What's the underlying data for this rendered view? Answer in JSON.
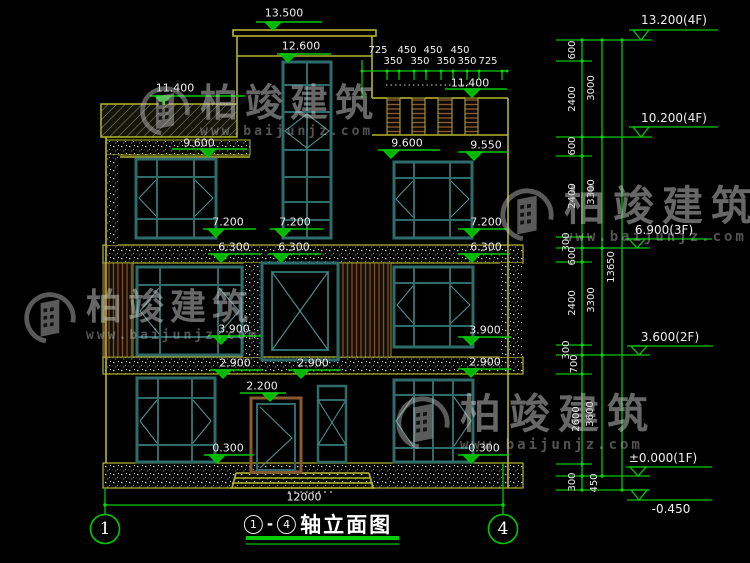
{
  "drawing": {
    "title": {
      "from": "1",
      "dash": "-",
      "to": "4",
      "name": "轴立面图"
    },
    "axes": {
      "a1": "1",
      "a4": "4"
    },
    "elev": {
      "v13500": "13.500",
      "v12600": "12.600",
      "v11400": "11.400",
      "v9600": "9.600",
      "v9550": "9.550",
      "v7200": "7.200",
      "v6300": "6.300",
      "v3900": "3.900",
      "v2900": "2.900",
      "v2200": "2.200",
      "v0300": "0.300"
    },
    "floors": {
      "f4r": "13.200(4F)",
      "f4": "10.200(4F)",
      "f3": "6.900(3F)",
      "f2": "3.600(2F)",
      "f1": "±0.000(1F)",
      "fg": "-0.450"
    },
    "dims": {
      "d725": "725",
      "d450": "450",
      "d350": "350",
      "d600": "600",
      "d2400": "2400",
      "d3000": "3000",
      "d3300": "3300",
      "d300": "300",
      "d700": "700",
      "d2600": "2600",
      "d3600": "3600",
      "d13650": "13650",
      "total_width": "12000"
    },
    "watermark": {
      "brand": "柏竣建筑",
      "url": "www.baijunjz.com"
    },
    "colors": {
      "background": "#000000",
      "wall_yellow": "#b5b52d",
      "dim_green": "#00c800",
      "window_teal": "#2e6b6b",
      "wood_brown": "#7a4f28",
      "text_white": "#f0f0f0"
    }
  }
}
